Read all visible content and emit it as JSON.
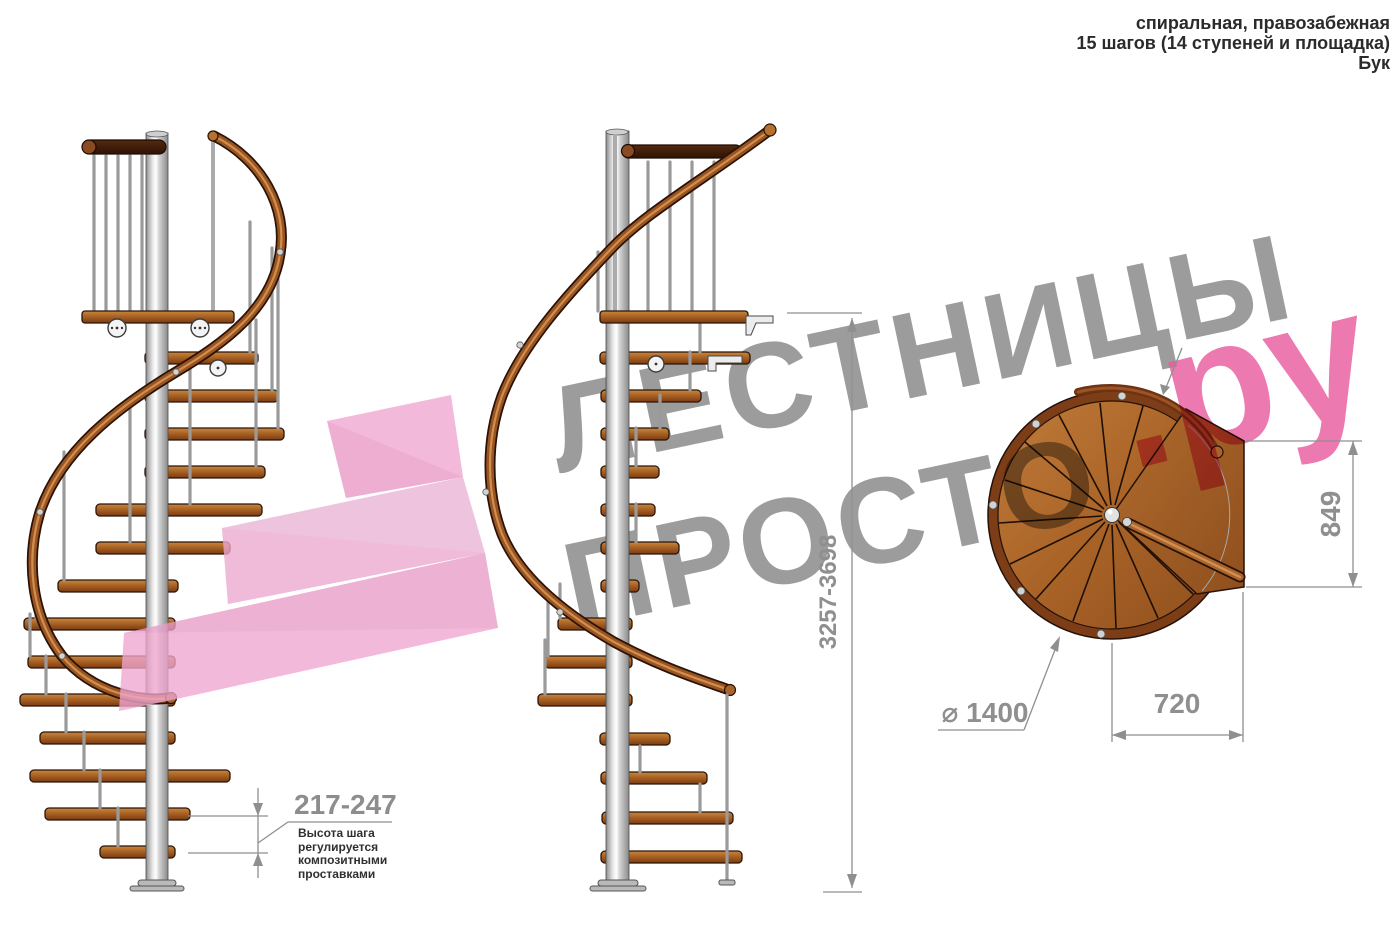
{
  "title_block": {
    "type": "спиральная, правозабежная",
    "steps": "15 шагов (14 ступеней и площадка)",
    "material": "Бук"
  },
  "watermark": {
    "word_top": "ЛЕСТНИЦЫ",
    "word_bottom": "ПРОСТО",
    "domain_suffix": ".ру",
    "text_color": "#9c9c9c",
    "suffix_color": "#e85d9f",
    "arrow_color": "#f0a6d0"
  },
  "dimensions": {
    "total_height_mm": "3257-3698",
    "plan_depth_mm": "849",
    "plan_width_mm": "720",
    "diameter_mm": "⌀ 1400",
    "step_height_mm": "217-247"
  },
  "note": {
    "step_height": "Высота шага\nрегулируется\nкомпозитными\nпроставками"
  },
  "drawing_colors": {
    "wood": "#a96327",
    "handrail": "#9a5422",
    "pole": "#d2d2d2",
    "outline": "#2b1508",
    "dimension_gray": "#8f8f8f"
  }
}
